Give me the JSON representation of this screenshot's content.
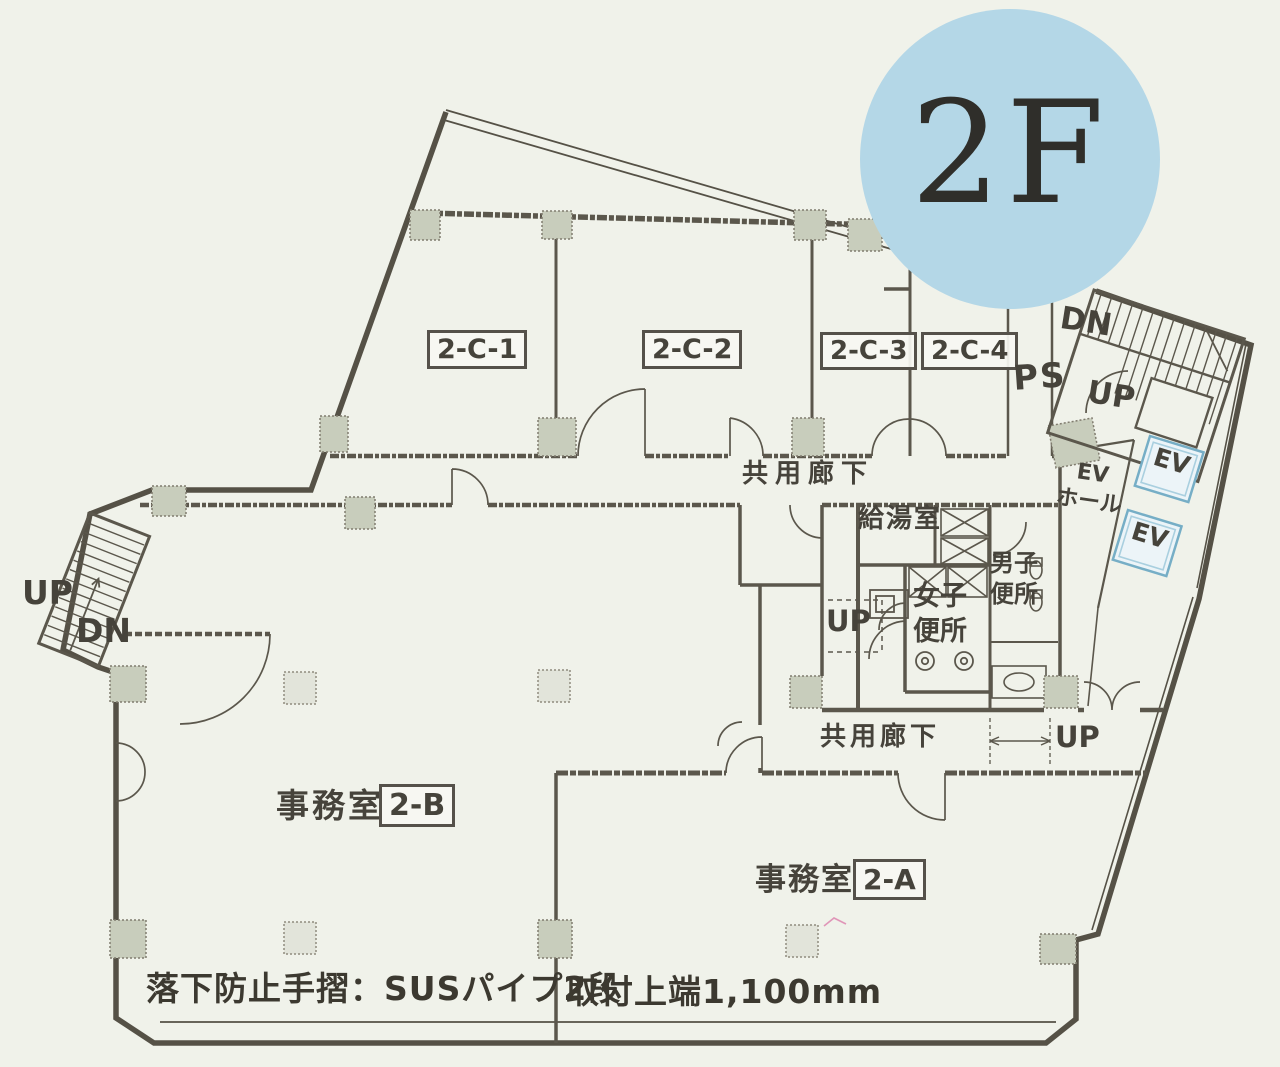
{
  "floor_badge": {
    "text": "2F",
    "bg": "#b4d7e7"
  },
  "units": {
    "c1": "2-C-1",
    "c2": "2-C-2",
    "c3": "2-C-3",
    "c4": "2-C-4",
    "a": "2-A",
    "b": "2-B"
  },
  "labels": {
    "office": "事務室",
    "corridor": "共用廊下",
    "kitchen": "給湯室",
    "womens_l1": "女子",
    "womens_l2": "便所",
    "mens_l1": "男子",
    "mens_l2": "便所",
    "ev_hall_l1": "EV",
    "ev_hall_l2": "ホール",
    "ev": "EV",
    "ps": "PS",
    "up": "UP",
    "dn": "DN"
  },
  "notes": {
    "handrail": "落下防止手摺：SUSパイプ2段",
    "mount": "取付上端1,100mm"
  },
  "colors": {
    "wall": "#5b574c",
    "column_fill": "#c8cdbc",
    "ev_blue": "#76aec6",
    "badge_blue": "#b4d7e7",
    "paper": "#f0f2ea"
  }
}
